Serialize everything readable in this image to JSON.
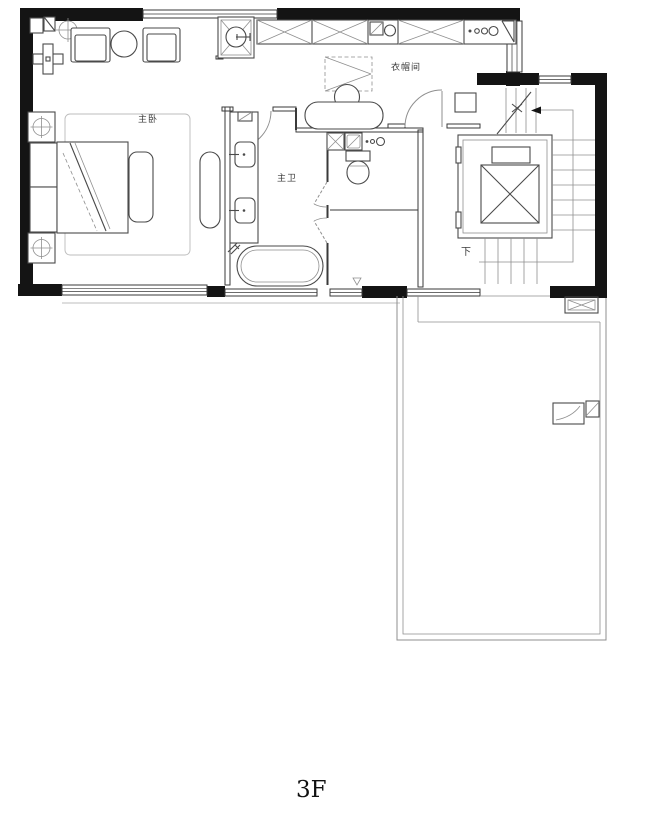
{
  "floor_plan": {
    "floor_label": "3F",
    "room_labels": {
      "master_bedroom": "主卧",
      "master_bathroom": "主卫",
      "cloakroom": "衣帽间",
      "stairs_down": "下"
    },
    "colors": {
      "wall": "#141414",
      "line": "#3a3a3a",
      "furniture": "#4a4a4a",
      "light": "#8f8f8f",
      "faint": "#bcbcbc",
      "text": "#3a3a3a",
      "bg": "#ffffff"
    }
  }
}
